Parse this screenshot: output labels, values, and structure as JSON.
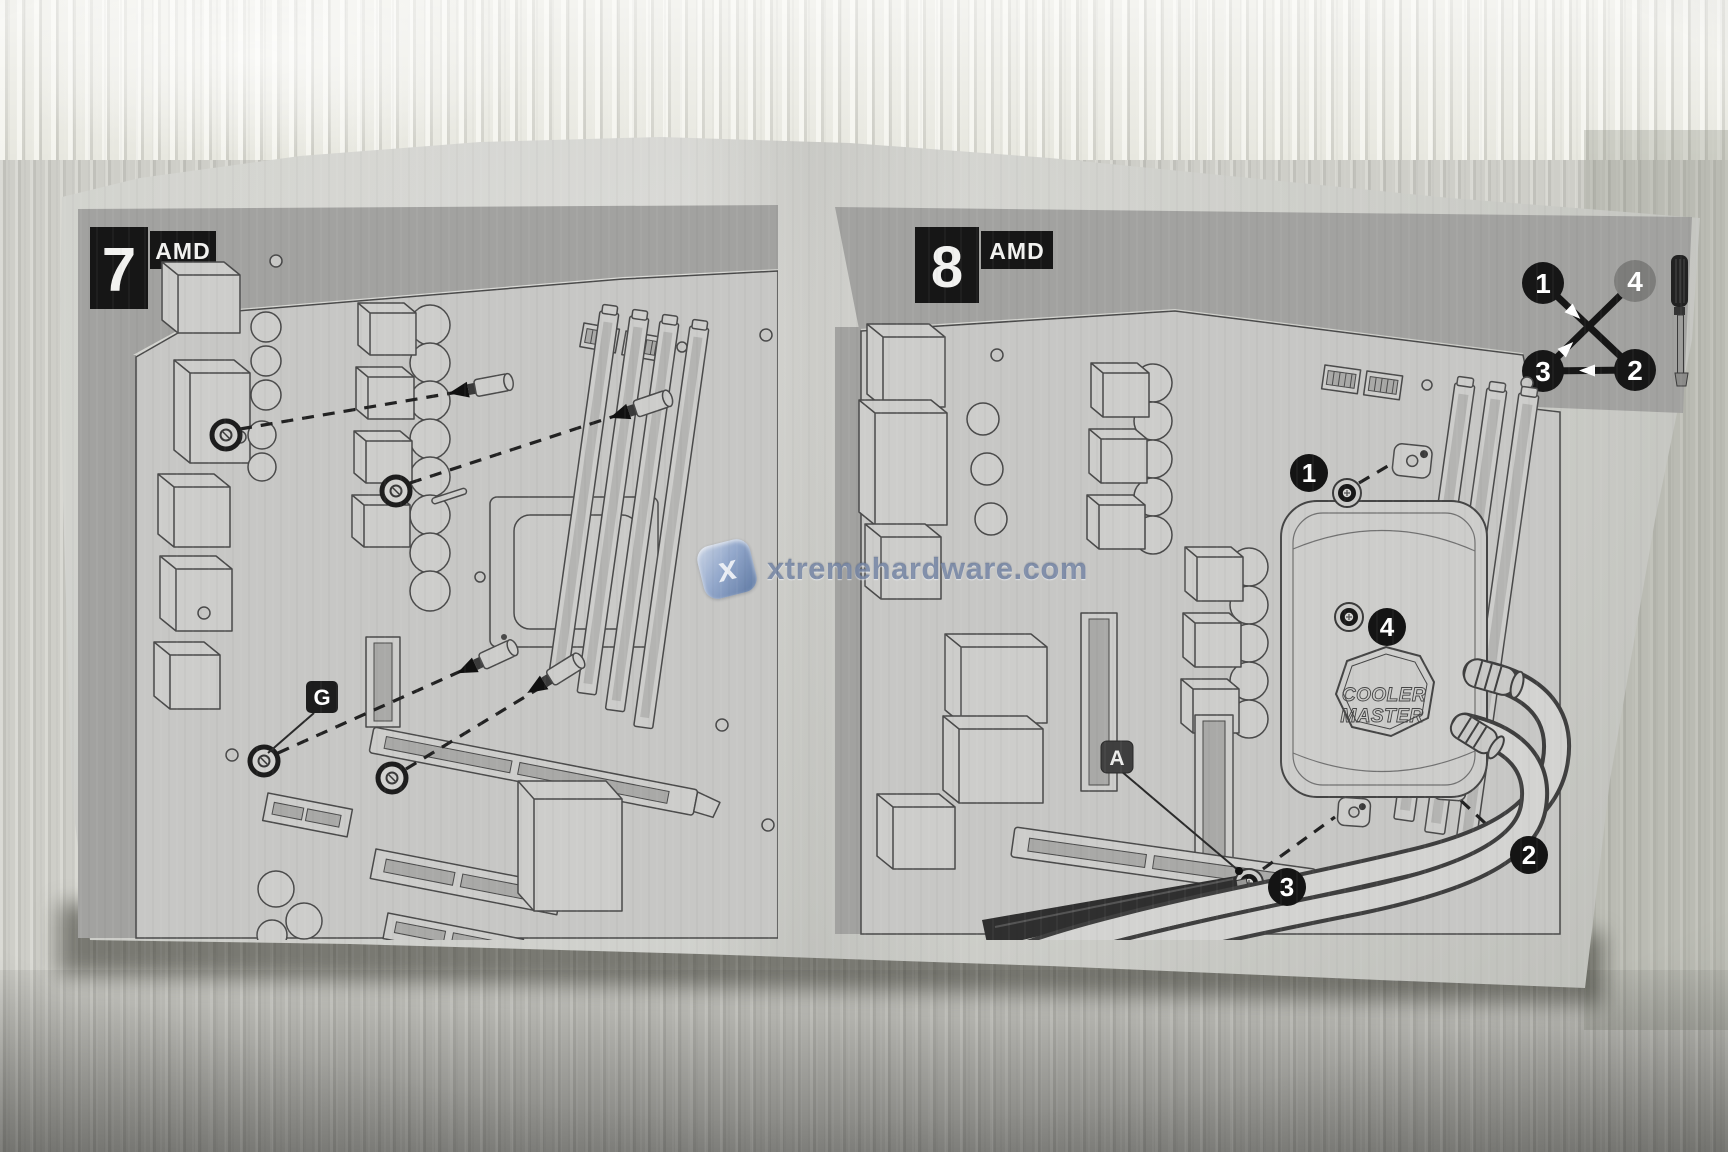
{
  "panel_7": {
    "step_number": "7",
    "platform_badge": "AMD",
    "fastener_label": "G"
  },
  "panel_8": {
    "step_number": "8",
    "platform_badge": "AMD",
    "tool_point_label": "A",
    "tighten_order_diagram": {
      "pos_top_left": "1",
      "pos_top_right": "4",
      "pos_bottom_left": "3",
      "pos_bottom_right": "2"
    },
    "screw_callouts": {
      "screw_1": "1",
      "screw_2": "2",
      "screw_3": "3",
      "screw_4": "4"
    },
    "pump_logo": {
      "line1": "COOLER",
      "line2": "MASTER"
    }
  },
  "watermark": {
    "logo_letter": "x",
    "text": "xtremehardware.com"
  },
  "colors": {
    "panel_band": "#a2a2a0",
    "board_fill": "#c7c7c5",
    "label_black": "#161616",
    "line_ink": "#4a4a4a",
    "watermark_blue": "#687a9c"
  }
}
